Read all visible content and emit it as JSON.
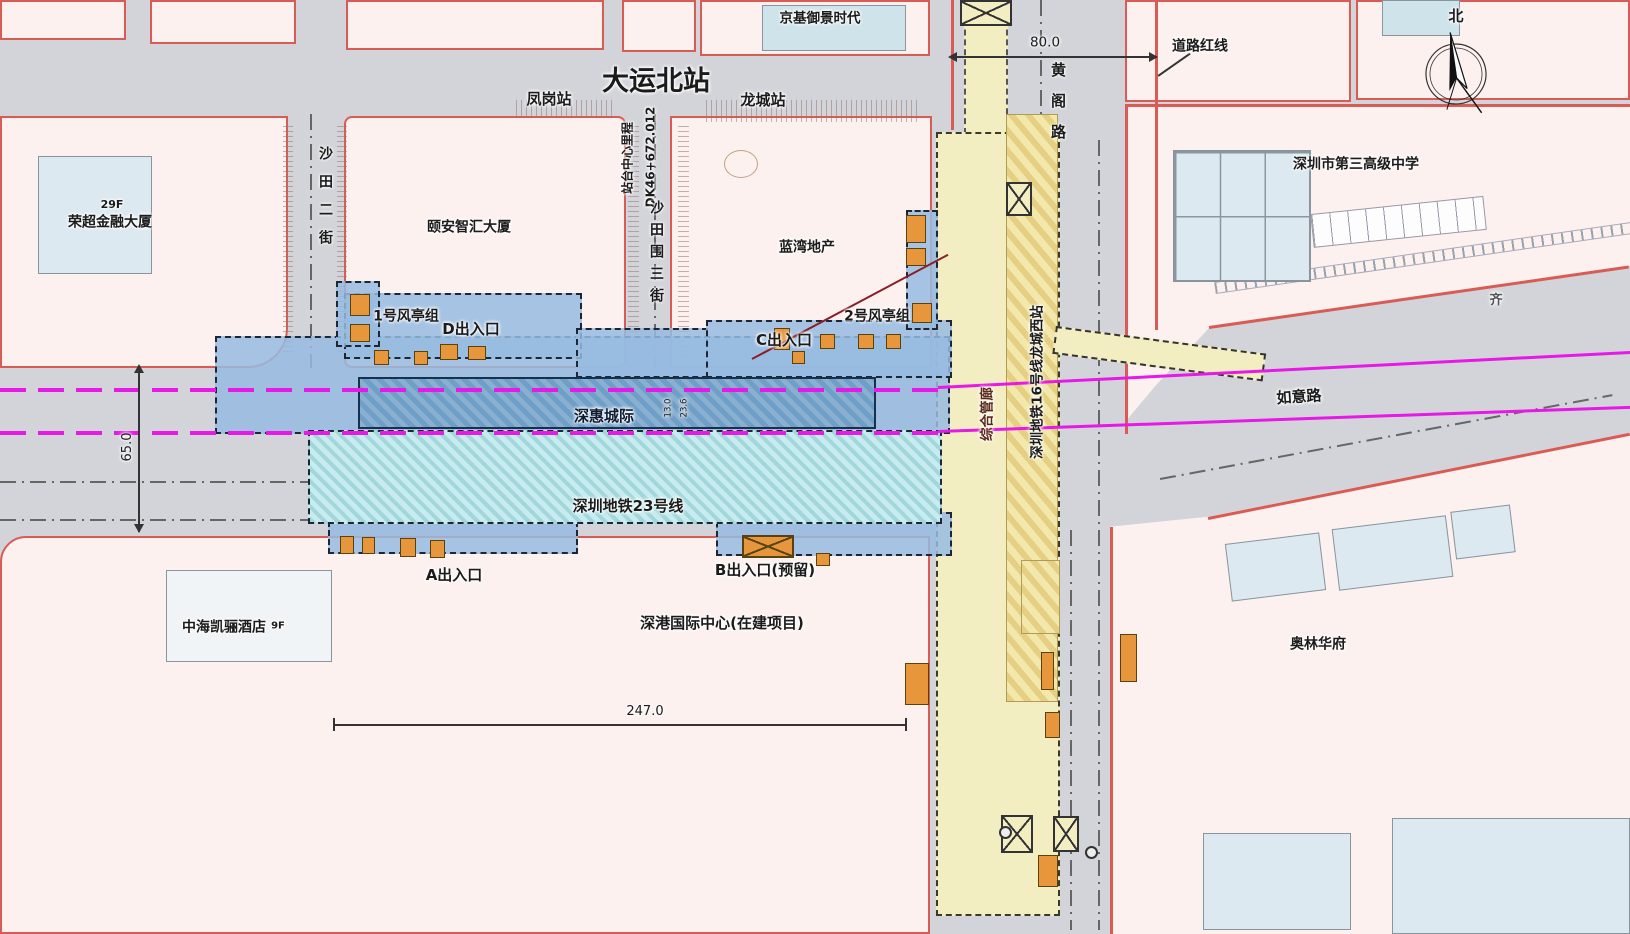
{
  "labels": {
    "title": "大运北站",
    "fenggang": "凤岗站",
    "longcheng": "龙城站",
    "kingkey": "京基御景时代",
    "school": "深圳市第三高级中学",
    "lanwan": "蓝湾地产",
    "yian": "颐安智汇大厦",
    "rongchao": "荣超金融大厦",
    "floors29": "29F",
    "hotel": "中海凯骊酒店",
    "floors9": "9F",
    "shengang": "深港国际中心(在建项目)",
    "aolin": "奥林华府",
    "ruyi": "如意路",
    "qi": "齐",
    "vent1": "1号风亭组",
    "exitD": "D出入口",
    "vent2": "2号风亭组",
    "exitC": "C出入口",
    "exitA": "A出入口",
    "exitB": "B出入口(预留)",
    "intercity": "深惠城际",
    "line23": "深圳地铁23号线",
    "utility": "综合管廊",
    "line16": "深圳地铁16号线龙城西站",
    "huangge": "黄阁路",
    "shatian2": "沙田二街",
    "shatianwei3": "沙田围三街",
    "mileage_label": "站台中心里程",
    "mileage_value": "DK46+672.012",
    "redline": "道路红线",
    "north": "北",
    "dim80": "80.0",
    "dim65": "65.0",
    "dim247": "247.0",
    "dim13": "13.0",
    "dim23": "23.6"
  },
  "colors": {
    "road_gray": "#d3d4da",
    "parcel_pink": "#fcf1ef",
    "parcel_red": "#d85c55",
    "station_blue": "#6f9ec7",
    "line23_cyan": "#c6ecef",
    "line16_yellow": "#f3edc2",
    "vent_orange": "#e8963c",
    "magenta": "#e619e6"
  }
}
